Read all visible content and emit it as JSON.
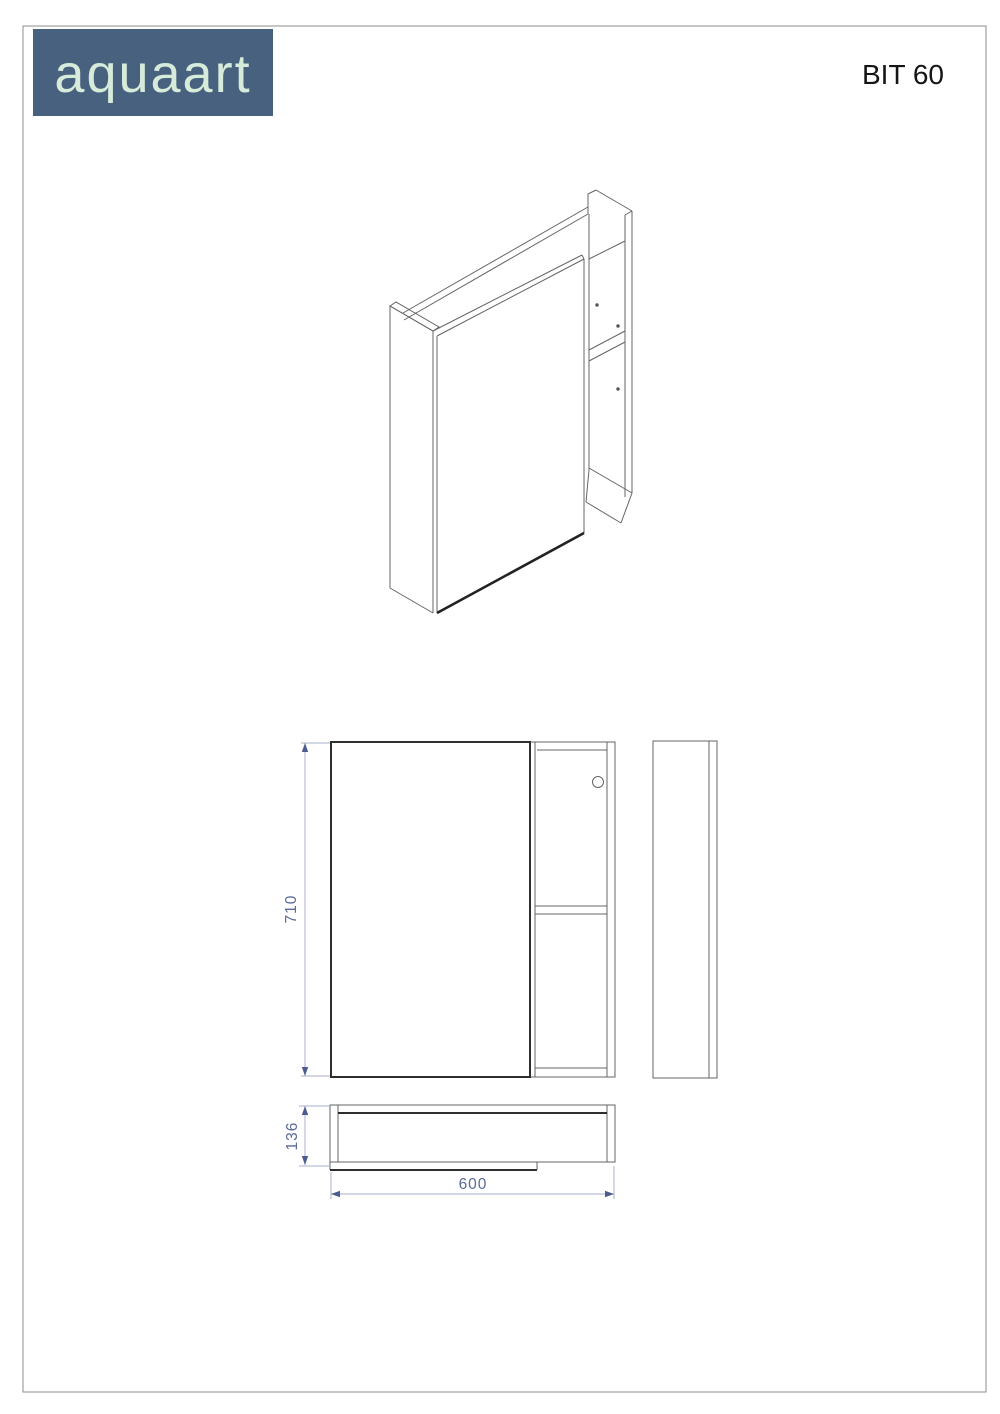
{
  "brand": {
    "logo_text": "aquaart"
  },
  "title": {
    "model": "BIT 60"
  },
  "dimensions": {
    "height": "710",
    "width": "600",
    "depth": "136"
  },
  "colors": {
    "logo_background": "#47617E",
    "logo_text": "#D6EBDA",
    "dimension_text": "#5A6A99",
    "dimension_line": "#A9B2CE",
    "drawing_line": "#646464",
    "drawing_dark_line": "#2E2E2E"
  }
}
